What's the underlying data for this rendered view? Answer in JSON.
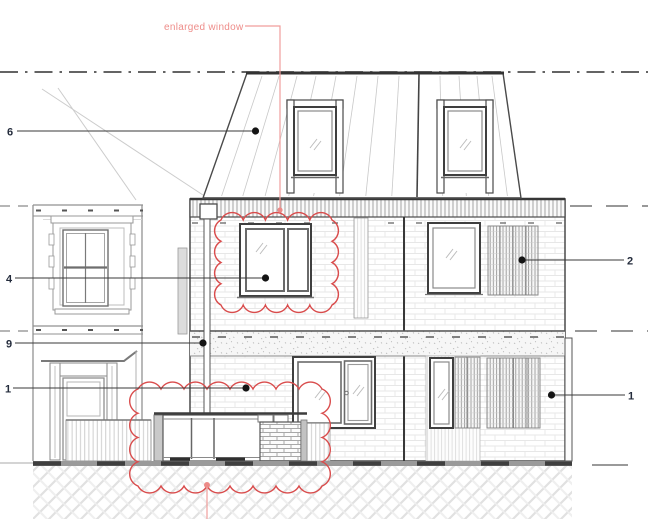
{
  "drawing": {
    "annotation": {
      "label": "enlarged window"
    },
    "callouts": {
      "c6": "6",
      "c4": "4",
      "c9": "9",
      "c1_left": "1",
      "c2": "2",
      "c1_right": "1"
    },
    "colors": {
      "revision_cloud": "#d94c4c",
      "annotation_red": "#ee8d8a",
      "leader_red": "#f19e9c",
      "linework": "#3f3f3f",
      "callout_label": "#242c3c"
    }
  }
}
